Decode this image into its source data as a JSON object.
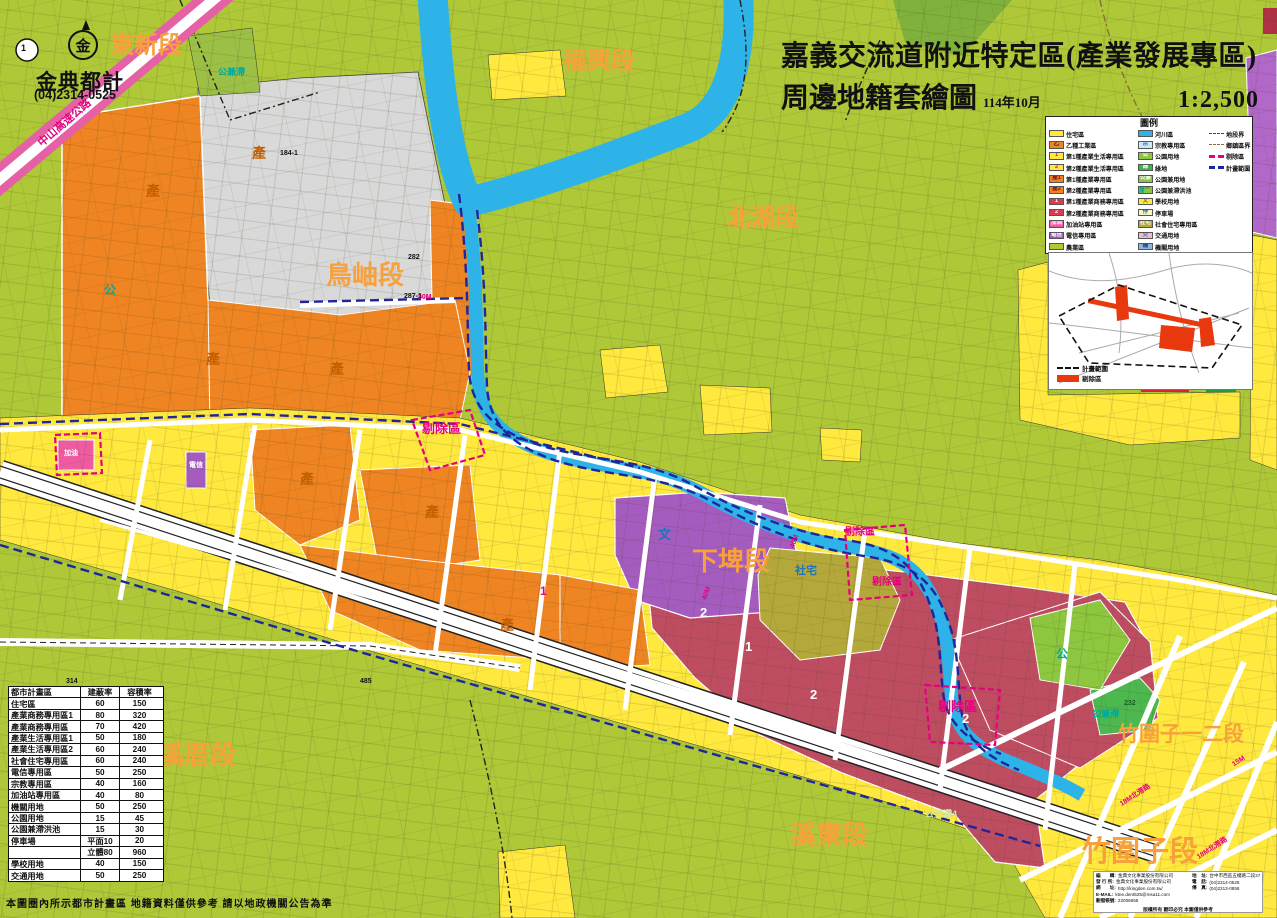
{
  "title": {
    "line1": "嘉義交流道附近特定區(產業發展專區)",
    "line2": "周邊地籍套繪圖",
    "date": "114年10月",
    "scale": "1:2,500"
  },
  "publisher": {
    "name": "金典都計",
    "phone": "(04)2314-0525",
    "logo_glyph": "金"
  },
  "legend": {
    "title": "圖例",
    "zone_items_left": [
      {
        "label": "住宅區",
        "badge": "",
        "ss": "background:#ffe93e",
        "bs": "color:#111"
      },
      {
        "label": "乙種工業區",
        "badge": "乙",
        "ss": "background:#ef8422",
        "bs": "color:#111"
      },
      {
        "label": "第1種產業生活專用區",
        "badge": "1",
        "ss": "background:#ffe93e",
        "bs": "color:#e5007f"
      },
      {
        "label": "第2種產業生活專用區",
        "badge": "2",
        "ss": "background:#ffe93e",
        "bs": "color:#e5007f"
      },
      {
        "label": "第1種產業專用區",
        "badge": "產1",
        "ss": "background:#ef8422",
        "bs": "color:#7b1010"
      },
      {
        "label": "第2種產業專用區",
        "badge": "產2",
        "ss": "background:#ef8422",
        "bs": "color:#7b1010"
      },
      {
        "label": "第1種產業商務專用區",
        "badge": "1",
        "ss": "background:#d63c52",
        "bs": "color:#fff"
      },
      {
        "label": "第2種產業商務專用區",
        "badge": "2",
        "ss": "background:#d63c52",
        "bs": "color:#fff"
      },
      {
        "label": "加油站專用區",
        "badge": "加油",
        "ss": "background:#ef5ba1",
        "bs": "color:#fff"
      },
      {
        "label": "電信專用區",
        "badge": "電信",
        "ss": "background:#a55cbf",
        "bs": "color:#fff"
      },
      {
        "label": "農業區",
        "badge": "",
        "ss": "background:#aec838",
        "bs": "color:#111"
      }
    ],
    "zone_items_right": [
      {
        "label": "河川區",
        "badge": "",
        "ss": "background:#2db3e8",
        "bs": "color:#111"
      },
      {
        "label": "宗教專用區",
        "badge": "宗",
        "ss": "background:#cde9f6",
        "bs": "color:#1c75bc"
      },
      {
        "label": "公園用地",
        "badge": "公",
        "ss": "background:#8dc63f",
        "bs": "color:#fff"
      },
      {
        "label": "綠地",
        "badge": "綠",
        "ss": "background:#39b54a",
        "bs": "color:#fff"
      },
      {
        "label": "公園兼用地",
        "badge": "公兼",
        "ss": "background:#8dc63f",
        "bs": "color:#fff"
      },
      {
        "label": "公園兼滯洪池",
        "badge": "公兼滯",
        "ss": "background:#8dc63f",
        "bs": "color:#00a99d"
      },
      {
        "label": "學校用地",
        "badge": "文",
        "ss": "background:#ffe93e",
        "bs": "color:#1c75bc"
      },
      {
        "label": "停車場",
        "badge": "停",
        "ss": "background:#fdf3c0",
        "bs": "color:#1c75bc"
      },
      {
        "label": "社會住宅專用區",
        "badge": "社宅",
        "ss": "background:#b5a83b",
        "bs": "color:#fff"
      },
      {
        "label": "交通用地",
        "badge": "交",
        "ss": "background:#f2b8d2",
        "bs": "color:#1c75bc"
      },
      {
        "label": "機關用地",
        "badge": "機",
        "ss": "background:#8fb4dd",
        "bs": "color:#1b3f73"
      }
    ],
    "line_items": [
      {
        "label": "地段界",
        "ls": "border-top:1.5px dashed #444"
      },
      {
        "label": "鄉鎮區界",
        "ls": "border-top:1.5px dashed #8a6d3b"
      },
      {
        "label": "剔除區",
        "ls": "border-top:3px dashed #e5007f"
      },
      {
        "label": "計畫範圍",
        "ls": "border-top:3px dashed #20269a"
      }
    ]
  },
  "inset": {
    "legend_boundary": "計畫範圍",
    "legend_excluded": "剔除區"
  },
  "table": {
    "headers": [
      "都市計畫區",
      "建蔽率",
      "容積率"
    ],
    "rows": [
      {
        "n": "住宅區",
        "a": "60",
        "b": "150"
      },
      {
        "n": "產業商務專用區1",
        "a": "80",
        "b": "320"
      },
      {
        "n": "產業商務專用區",
        "a": "70",
        "b": "420"
      },
      {
        "n": "產業生活專用區1",
        "a": "50",
        "b": "180"
      },
      {
        "n": "產業生活專用區2",
        "a": "60",
        "b": "240"
      },
      {
        "n": "社會住宅專用區",
        "a": "60",
        "b": "240"
      },
      {
        "n": "電信專用區",
        "a": "50",
        "b": "250"
      },
      {
        "n": "宗教專用區",
        "a": "40",
        "b": "160"
      },
      {
        "n": "加油站專用區",
        "a": "40",
        "b": "80"
      },
      {
        "n": "機關用地",
        "a": "50",
        "b": "250"
      },
      {
        "n": "公園用地",
        "a": "15",
        "b": "45"
      },
      {
        "n": "公園兼滯洪池",
        "a": "15",
        "b": "30"
      },
      {
        "n": "停車場",
        "a": "平面10",
        "b": "20"
      },
      {
        "n": "",
        "a": "立體80",
        "b": "960"
      },
      {
        "n": "學校用地",
        "a": "40",
        "b": "150"
      },
      {
        "n": "交通用地",
        "a": "50",
        "b": "250"
      }
    ]
  },
  "info_box": {
    "left_rows": [
      {
        "k": "編　　輯:",
        "v": "金典文化事業股份有限公司"
      },
      {
        "k": "發 行 所:",
        "v": "金典文化事業股份有限公司"
      },
      {
        "k": "網　　址:",
        "v": "http://kingden.com.tw/"
      },
      {
        "k": "E-MAIL:",
        "v": "ktne.dent525@msa11.com"
      },
      {
        "k": "劃撥帳號:",
        "v": "22006655"
      }
    ],
    "right_rows": [
      {
        "k": "地　址:",
        "v": "台中市西區五權路二段27號"
      },
      {
        "k": "電　話:",
        "v": "(04)2314-0525"
      },
      {
        "k": "傳　真:",
        "v": "(04)2313-0858"
      }
    ],
    "footer": "版權所有 翻印必究 本圖僅供參考"
  },
  "disclaimer": "本圖圈內所示都市計畫區 地籍資料僅供參考 請以地政機關公告為準",
  "map": {
    "labels": [
      {
        "t": "東新段",
        "s": "left:110px;top:34px;font-size:24px;color:#f8a13c"
      },
      {
        "t": "福興段",
        "s": "left:563px;top:50px;font-size:24px;color:#f8a13c"
      },
      {
        "t": "北湖段",
        "s": "left:727px;top:207px;font-size:24px;color:#f8a13c"
      },
      {
        "t": "鳥岫段",
        "s": "left:326px;top:262px;font-size:26px;color:#f8a13c"
      },
      {
        "t": "下埤段",
        "s": "left:692px;top:548px;font-size:26px;color:#f8a13c"
      },
      {
        "t": "溪厝段",
        "s": "left:158px;top:742px;font-size:26px;color:#f8a13c"
      },
      {
        "t": "溪東段",
        "s": "left:790px;top:822px;font-size:26px;color:#f8a13c"
      },
      {
        "t": "竹圍子一二段",
        "s": "left:1118px;top:724px;font-size:21px;color:#f8a13c"
      },
      {
        "t": "竹圍子段",
        "s": "left:1082px;top:838px;font-size:29px;color:#f8a13c"
      },
      {
        "t": "剔除區",
        "s": "left:422px;top:422px;font-size:13px;color:#e5007f"
      },
      {
        "t": "剔除區",
        "s": "left:845px;top:528px;font-size:10px;color:#e5007f"
      },
      {
        "t": "剔除區",
        "s": "left:872px;top:578px;font-size:10px;color:#e5007f"
      },
      {
        "t": "剔除區",
        "s": "left:938px;top:700px;font-size:13px;color:#e5007f"
      },
      {
        "t": "中山高速公路",
        "s": "left:32px;top:118px;font-size:11px;color:#e5007f;transform:rotate(-41deg)"
      },
      {
        "t": "產",
        "s": "left:146px;top:184px;font-size:14px;color:#c35f00"
      },
      {
        "t": "產",
        "s": "left:252px;top:146px;font-size:14px;color:#c35f00"
      },
      {
        "t": "產",
        "s": "left:206px;top:352px;font-size:14px;color:#c35f00"
      },
      {
        "t": "產",
        "s": "left:330px;top:362px;font-size:14px;color:#c35f00"
      },
      {
        "t": "產",
        "s": "left:300px;top:472px;font-size:14px;color:#c35f00"
      },
      {
        "t": "產",
        "s": "left:425px;top:505px;font-size:14px;color:#c35f00"
      },
      {
        "t": "產",
        "s": "left:500px;top:618px;font-size:14px;color:#c35f00"
      },
      {
        "t": "文",
        "s": "left:658px;top:528px;font-size:13px;color:#1c75bc"
      },
      {
        "t": "社宅",
        "s": "left:795px;top:566px;font-size:11px;color:#1c75bc"
      },
      {
        "t": "公兼滯",
        "s": "left:218px;top:68px;font-size:9px;color:#00a99d"
      },
      {
        "t": "公兼滯",
        "s": "left:1092px;top:710px;font-size:9px;color:#00a99d"
      },
      {
        "t": "公兼滯4",
        "s": "left:925px;top:810px;font-size:9px;color:#cfe8a0"
      },
      {
        "t": "公",
        "s": "left:104px;top:284px;font-size:12px;color:#00a99d"
      },
      {
        "t": "公",
        "s": "left:1056px;top:648px;font-size:12px;color:#00a99d"
      },
      {
        "t": "電信",
        "s": "left:189px;top:462px;font-size:7px;color:#fff"
      },
      {
        "t": "加油",
        "s": "left:64px;top:450px;font-size:7px;color:#fff"
      },
      {
        "t": "2",
        "s": "left:700px;top:606px;font-size:13px;color:#fff"
      },
      {
        "t": "2",
        "s": "left:810px;top:688px;font-size:13px;color:#fff"
      },
      {
        "t": "2",
        "s": "left:962px;top:712px;font-size:13px;color:#fff"
      },
      {
        "t": "1",
        "s": "left:745px;top:640px;font-size:13px;color:#fff"
      },
      {
        "t": "1",
        "s": "left:540px;top:585px;font-size:12px;color:#e5007f"
      },
      {
        "t": "2",
        "s": "left:150px;top:780px;font-size:12px;color:#1c75bc"
      },
      {
        "t": "30M",
        "s": "left:418px;top:294px;font-size:7px;color:#e5007f"
      },
      {
        "t": "40M",
        "s": "left:788px;top:538px;font-size:7px;color:#e5007f;transform:rotate(-70deg)"
      },
      {
        "t": "40M",
        "s": "left:700px;top:590px;font-size:7px;color:#e5007f;transform:rotate(-70deg)"
      },
      {
        "t": "18M北港路",
        "s": "left:1118px;top:792px;font-size:7px;color:#e5007f;transform:rotate(-33deg)"
      },
      {
        "t": "18M北港路",
        "s": "left:1195px;top:845px;font-size:7px;color:#e5007f;transform:rotate(-33deg)"
      },
      {
        "t": "15M",
        "s": "left:1232px;top:758px;font-size:7px;color:#e5007f;transform:rotate(-33deg)"
      },
      {
        "t": "282",
        "s": "left:408px;top:254px;font-size:7px;color:#111"
      },
      {
        "t": "287-1",
        "s": "left:404px;top:293px;font-size:7px;color:#111"
      },
      {
        "t": "184-1",
        "s": "left:280px;top:150px;font-size:7px;color:#111"
      },
      {
        "t": "314",
        "s": "left:66px;top:678px;font-size:7px;color:#111"
      },
      {
        "t": "485",
        "s": "left:360px;top:678px;font-size:7px;color:#111"
      },
      {
        "t": "232",
        "s": "left:1124px;top:700px;font-size:7px;color:#1b5e20"
      },
      {
        "t": "1",
        "s": "left:21px;top:44px;font-size:9px;color:#111"
      }
    ]
  }
}
